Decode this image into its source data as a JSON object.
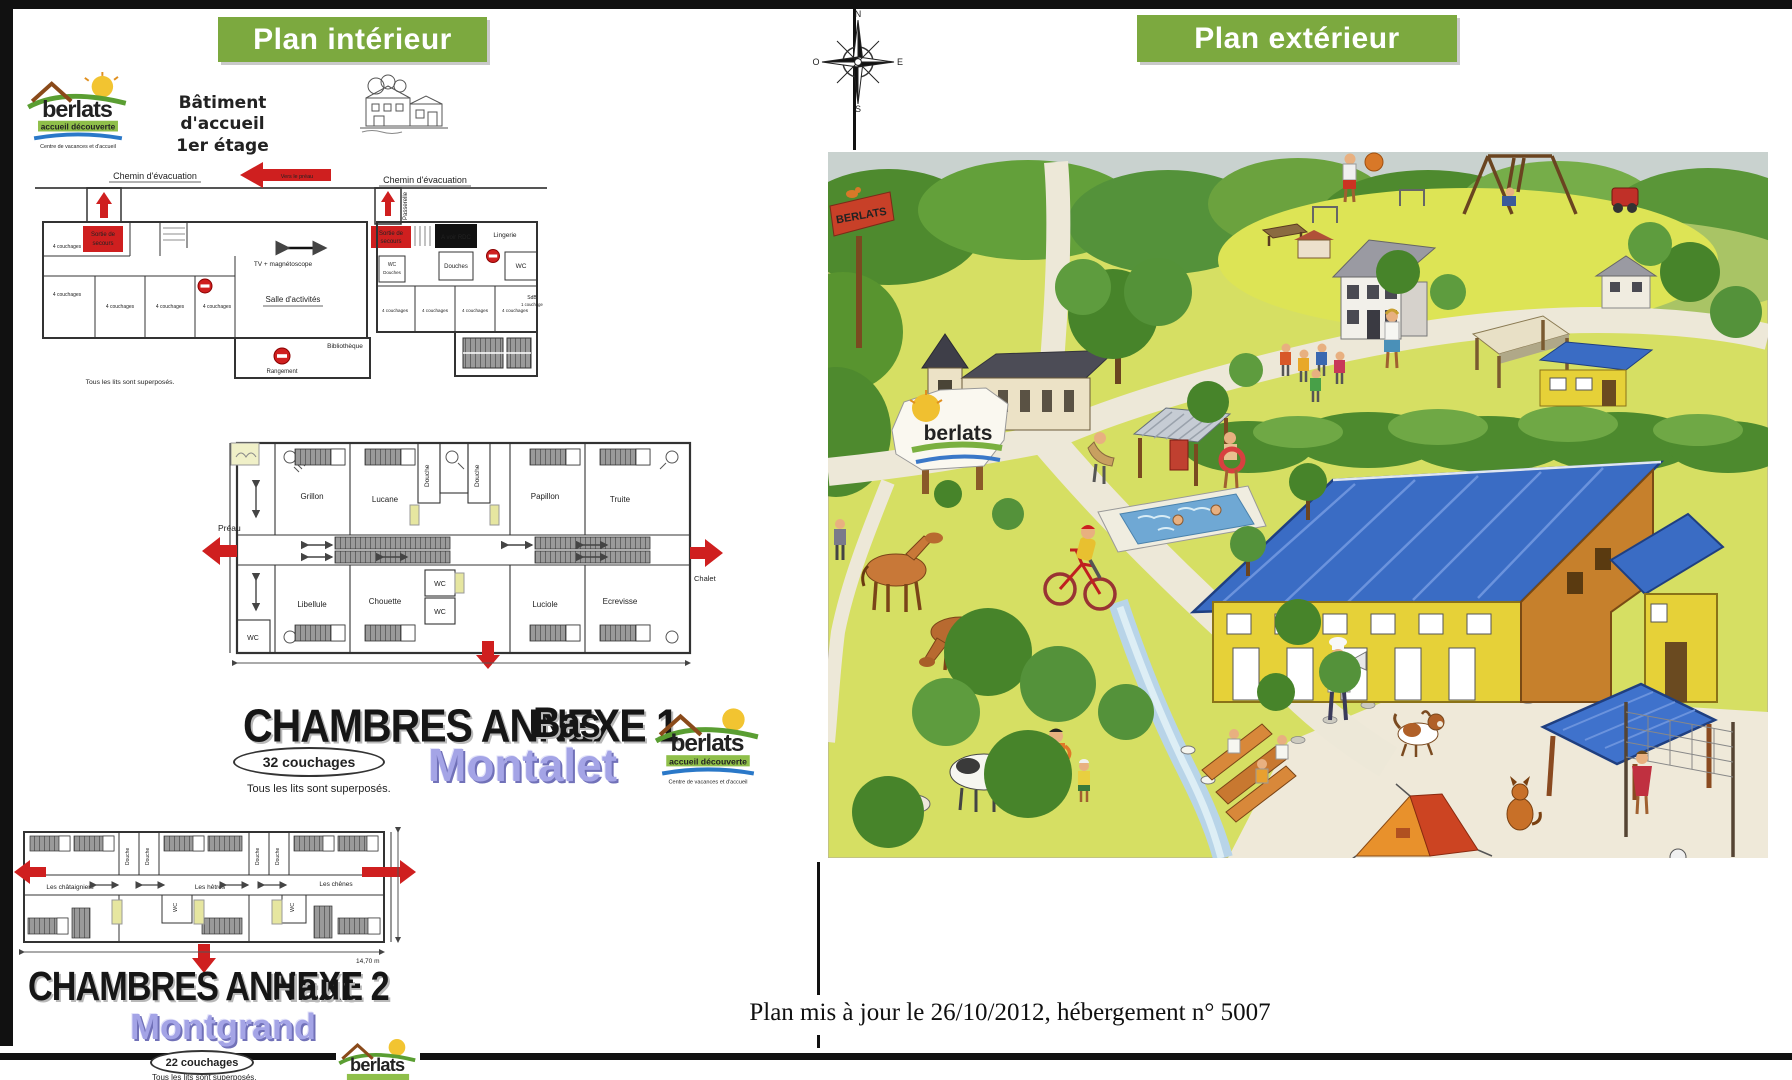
{
  "banners": {
    "left": "Plan intérieur",
    "right": "Plan extérieur"
  },
  "compass": {
    "north": "N",
    "south": "S",
    "east": "E",
    "west": "O"
  },
  "logo": {
    "name": "berlats",
    "tagline": "accueil découverte",
    "subtitle": "Centre de vacances et d'accueil"
  },
  "accueil": {
    "title_line1": "Bâtiment d'accueil",
    "title_line2": "1er étage",
    "evacuation_left": "Chemin d'évacuation",
    "evacuation_right": "Chemin d'évacuation",
    "vers_le_preau": "Vers le préau",
    "sortie_line1": "Sortie de",
    "sortie_line2": "secours",
    "passerelle": "Passerelle",
    "tv": "TV + magnétoscope",
    "salle_activites": "Salle d'activités",
    "bibliotheque": "Bibliothèque",
    "rangement": "Rangement",
    "a_voir_rdc": "A voir RDC",
    "lingerie": "Lingerie",
    "douches": "Douches",
    "wc": "WC",
    "sdb": "SdB",
    "couchage1": "1 couchage",
    "couchages4": "4 couchages",
    "beds_note": "Tous les lits sont superposés."
  },
  "annexe1": {
    "title": "CHAMBRES ANNEXE 1",
    "level": "Bas",
    "capacity": "32 couchages",
    "beds_note": "Tous les lits sont superposés.",
    "building": "Montalet",
    "preau": "Préau",
    "chalet": "Chalet",
    "douche": "Douche",
    "wc": "WC",
    "rooms_top": [
      "Grillon",
      "Lucane",
      "Papillon",
      "Truite"
    ],
    "rooms_bottom": [
      "Libellule",
      "Chouette",
      "Luciole",
      "Ecrevisse"
    ]
  },
  "annexe2": {
    "title": "CHAMBRES ANNEXE 2",
    "level": "Haut",
    "capacity": "22 couchages",
    "beds_note": "Tous les lits sont superposés.",
    "building": "Montgrand",
    "douche": "Douche",
    "wc": "WC",
    "dimension": "14,70 m",
    "rooms": [
      "Les châtaigniers",
      "Les hêtres",
      "Les chênes"
    ]
  },
  "exterior": {
    "sign": "BERLATS"
  },
  "footer": {
    "note": "Plan mis à jour le 26/10/2012, hébergement n° 5007"
  },
  "colors": {
    "banner_green": "#7CA93F",
    "arrow_red": "#CF1F1F",
    "purple": "#A4A4E6",
    "roof_blue": "#3A6CC4"
  }
}
